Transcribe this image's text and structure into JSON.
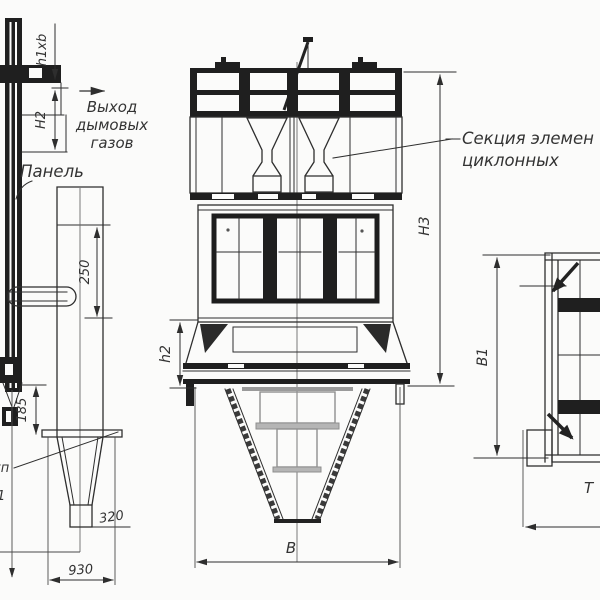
{
  "drawing": {
    "background": "#fbfbfa",
    "ink": "#2e2e2e",
    "gray_detail": "#8f8f8f"
  },
  "left_view": {
    "duct_section_dim": "h1xb",
    "duct_height_dim": "Н2",
    "gas_outlet_note": {
      "line1": "Выход",
      "line2": "дымовых",
      "line3": "газов"
    },
    "panel_note": "Панель",
    "dim_250": "250",
    "dim_185": "185",
    "dim_320": "320",
    "dim_930": "930",
    "clipped_note": {
      "line1": "уп",
      "line2": "1"
    }
  },
  "front_view": {
    "dim_h2": "h2",
    "dim_H3": "Н3",
    "dim_B": "В",
    "section_note": {
      "line1": "Секция элемен",
      "line2": "циклонных"
    }
  },
  "right_view": {
    "dim_B1": "В1",
    "clipped_note": "Т"
  }
}
